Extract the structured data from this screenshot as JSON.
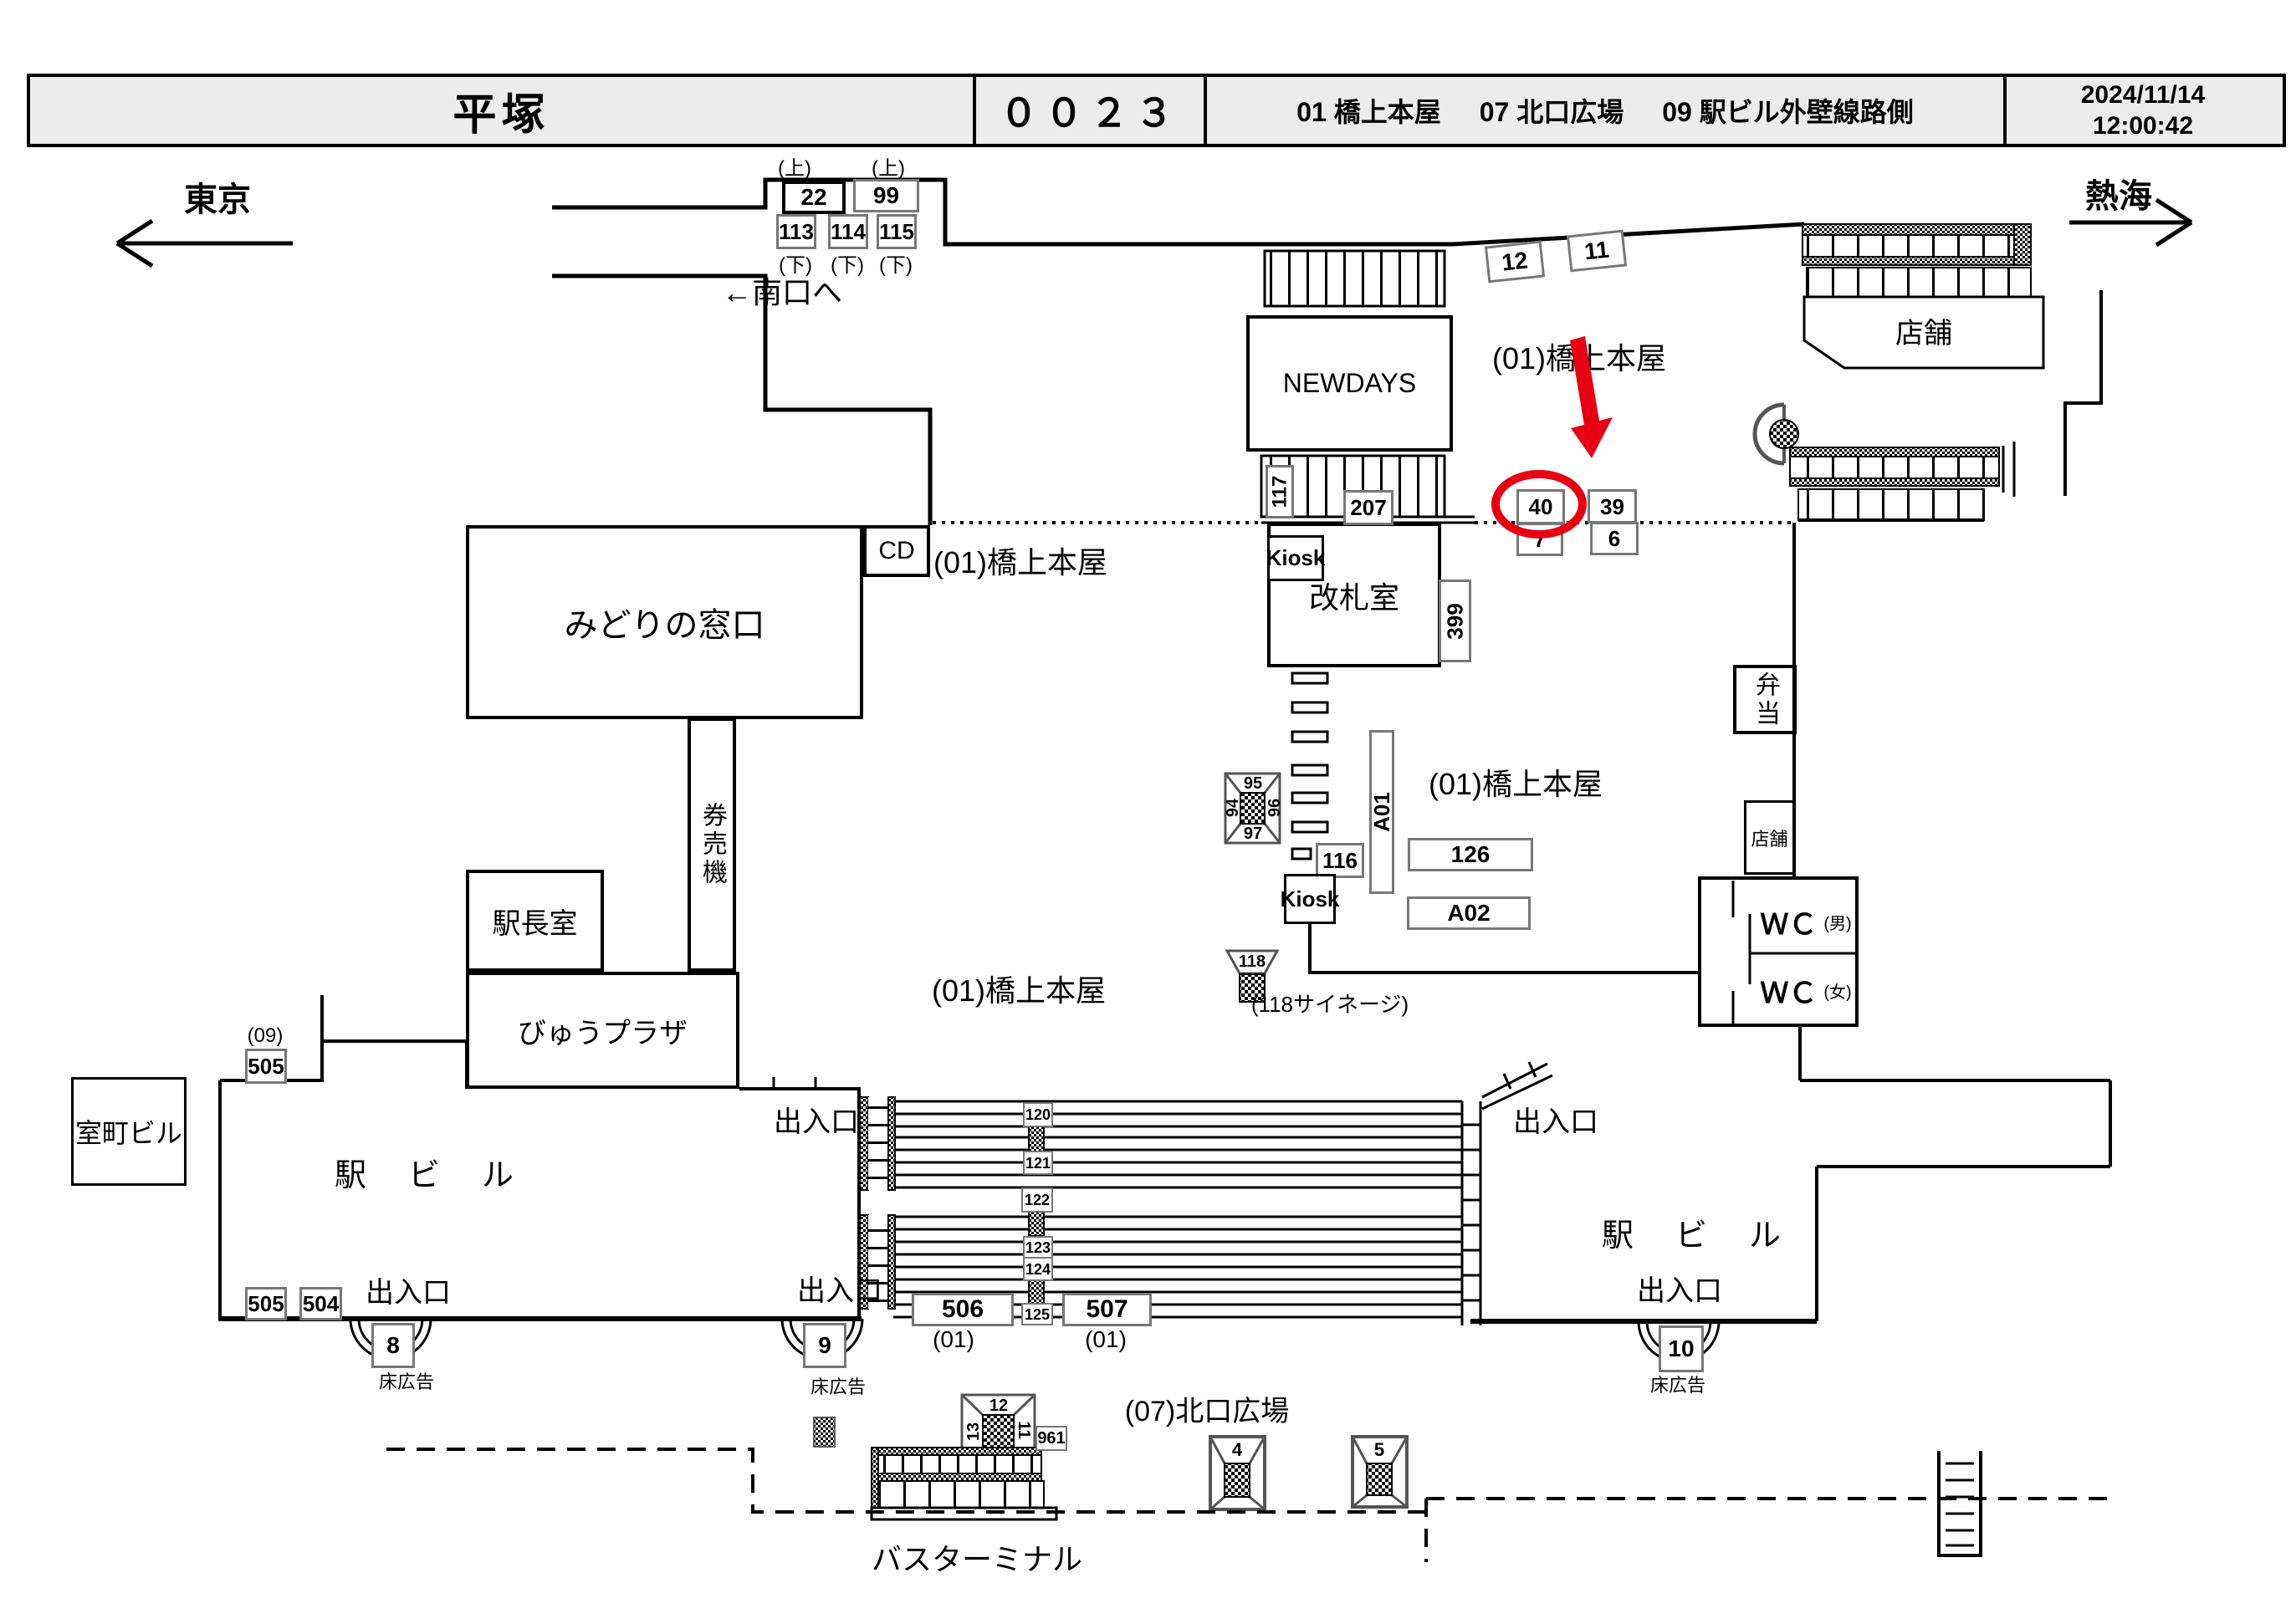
{
  "colors": {
    "highlight_red": "#e60012",
    "header_bg": "#ececec",
    "gray_border": "#777"
  },
  "header": {
    "station_name": "平塚",
    "board_code": "００２３",
    "category_01": "01 橋上本屋",
    "category_07": "07 北口広場",
    "category_09": "09 駅ビル外壁線路側",
    "date": "2024/11/14",
    "time": "12:00:42"
  },
  "directions": {
    "left": "東京",
    "right": "熱海",
    "south_exit": "←南口へ"
  },
  "labels": {
    "bridge_area": "(01)橋上本屋",
    "north_plaza": "(07)北口広場",
    "station_building": "駅　ビ　ル",
    "exit": "出入口",
    "floor_ad": "床広告",
    "bus_terminal": "バスターミナル",
    "up": "(上)",
    "down": "(下)",
    "paren01": "(01)",
    "paren09": "(09)",
    "signage_118": "(118サイネージ)",
    "shop": "店舗",
    "kiosk": "Kiosk"
  },
  "rooms": {
    "midori_no_madoguchi": "みどりの窓口",
    "cd": "CD",
    "kenbaiki": "券売機",
    "ekichoshitsu": "駅長室",
    "view_plaza": "びゅうプラザ",
    "kaisatsushitsu": "改札室",
    "newdays": "NEWDAYS",
    "bento": "弁当",
    "wc": "ＷＣ",
    "wc_male": "(男)",
    "wc_female": "(女)",
    "muromachi_building": "室町ビル"
  },
  "spots": {
    "s4": "4",
    "s5": "5",
    "s6": "6",
    "s7": "7",
    "s8": "8",
    "s9": "9",
    "s10": "10",
    "s11": "11",
    "s12": "12",
    "s13": "13",
    "s22": "22",
    "s39": "39",
    "s40": "40",
    "s99": "99",
    "s113": "113",
    "s114": "114",
    "s115": "115",
    "s116": "116",
    "s117": "117",
    "s118": "118",
    "s120": "120",
    "s121": "121",
    "s122": "122",
    "s123": "123",
    "s124": "124",
    "s125": "125",
    "s126": "126",
    "s207": "207",
    "s399": "399",
    "s504": "504",
    "s505": "505",
    "s506": "506",
    "s507": "507",
    "s961": "961",
    "a01": "A01",
    "a02": "A02"
  }
}
